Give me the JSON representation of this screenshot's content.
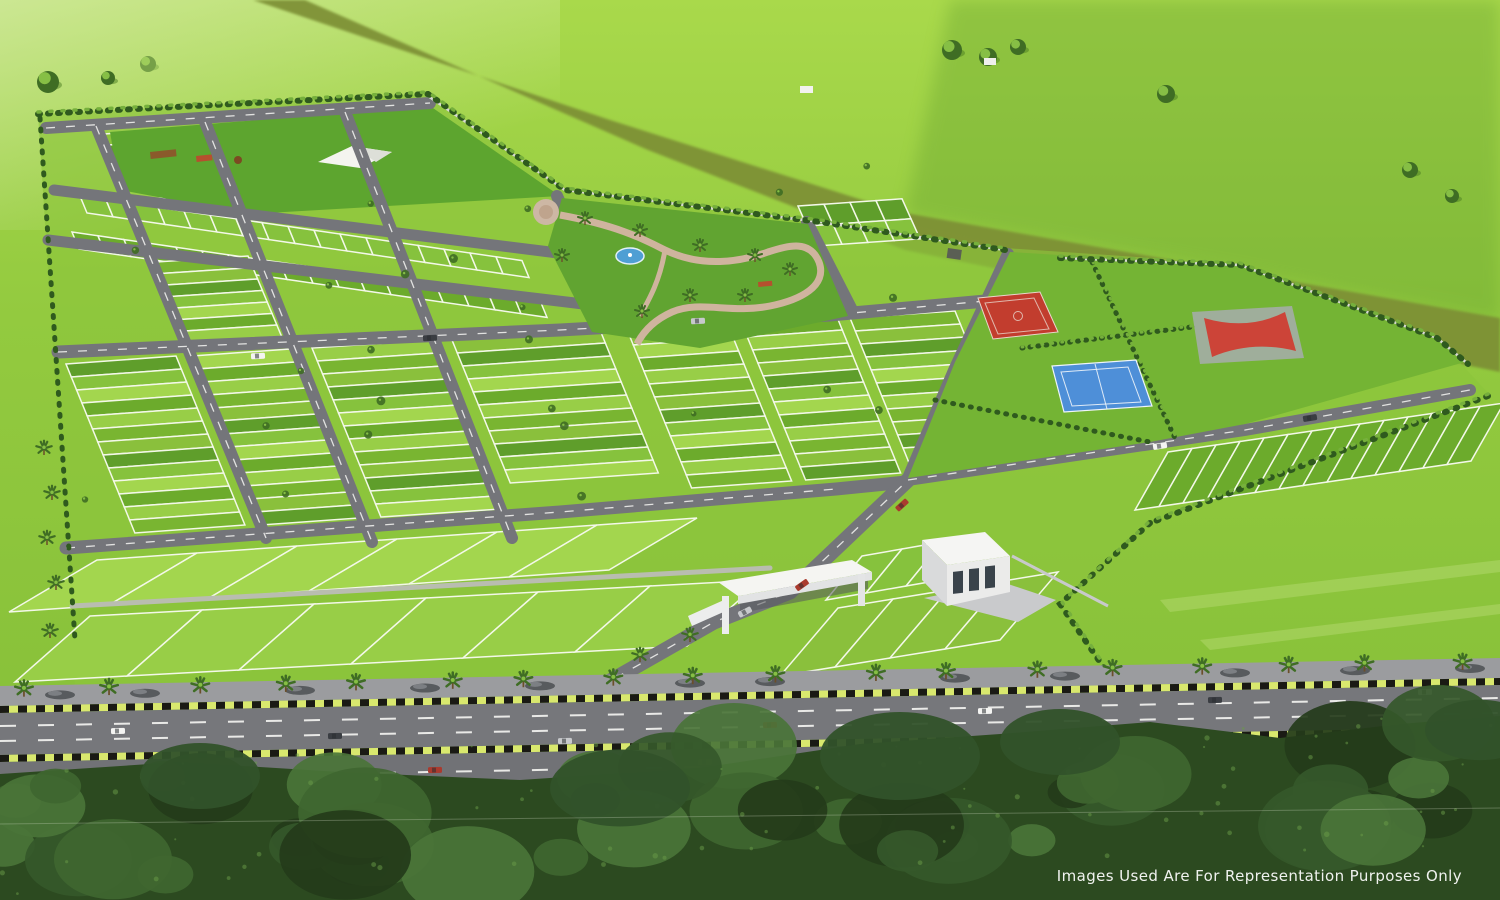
{
  "overlay": {
    "disclaimer": "Images Used Are For Representation Purposes Only"
  },
  "scene_type": "aerial-3d-render-of-plotted-township-layout",
  "colors": {
    "field_base": "#8cc43c",
    "field_bright": "#a9d94b",
    "field_mid": "#93ca3f",
    "field_low": "#83bd37",
    "field_far": "#679f2c",
    "haze": "#eef5da",
    "dirt_road": "#7d8f36",
    "plot_line": "#f3f8e8",
    "road": "#74757a",
    "road_line": "#f6f6f3",
    "walkway": "#b9bdb0",
    "hedge_dark": "#2f5a1e",
    "hedge_light": "#76b03c",
    "tree_dark": "#3f6d24",
    "tree_light": "#86bf45",
    "park_lawn": "#61a431",
    "park_path": "#cfb49e",
    "pond": "#4f9fd4",
    "court_red": "#c23d2e",
    "court_blue": "#4e8fd8",
    "court_line": "#e9d6cc",
    "court_gray": "#9fae9b",
    "gate_white": "#f5f5f2",
    "building_shade": "#d9dadb",
    "window_dark": "#3a434b",
    "sidewalk": "#9b9c9f",
    "median_light": "#d9e86e",
    "median_dark": "#1a1a14",
    "forest_base": "#2c4a20",
    "forest_light": "#47702f",
    "disclaimer_text": "#ffffff"
  },
  "plot_palette": [
    "#8ac03c",
    "#79b531",
    "#98ce47",
    "#6cab2c",
    "#a3d64e",
    "#86c23d",
    "#5f9e2b"
  ],
  "car_palette": [
    "#f4f4f2",
    "#3a3d42",
    "#c7c9cc",
    "#aa3a2e"
  ]
}
